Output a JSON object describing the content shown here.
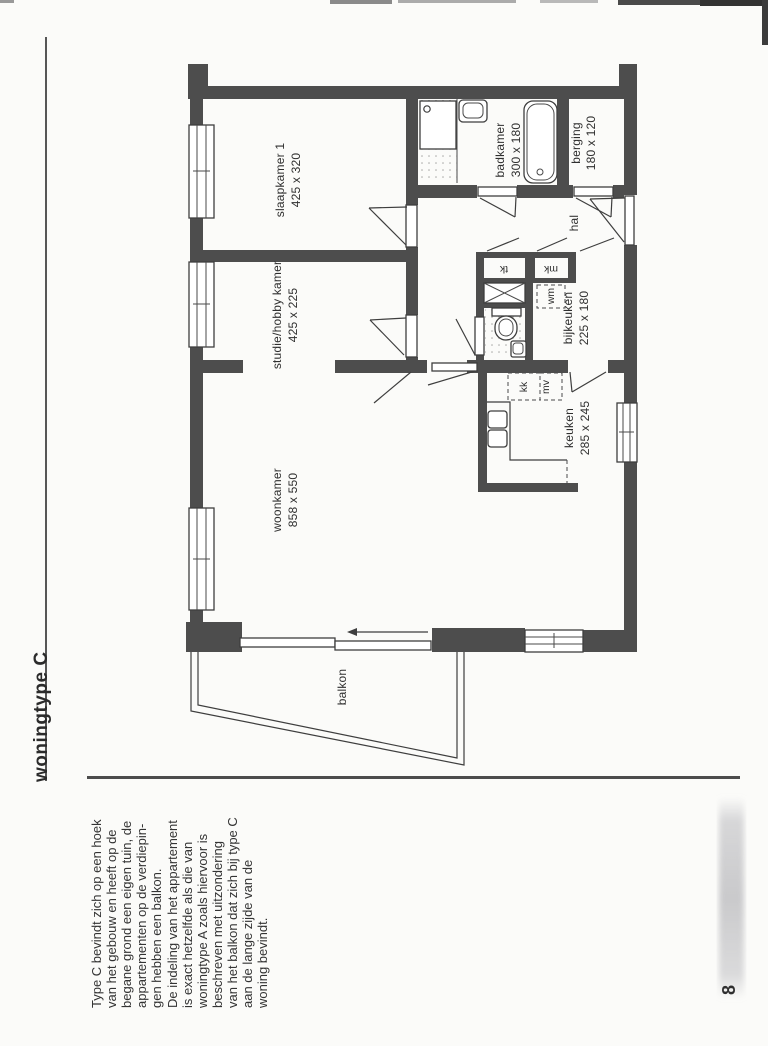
{
  "page": {
    "title": "woningtype C",
    "page_number": "8",
    "paragraph_lines": [
      "Type C bevindt zich op een hoek",
      "van het gebouw en heeft op de",
      "begane grond een eigen tuin, de",
      "appartementen op de verdiepin-",
      "gen hebben een balkon.",
      "De indeling van het appartement",
      "is exact hetzelfde als die van",
      "woningtype A  zoals hiervoor is",
      "beschreven met uitzondering",
      "van het balkon dat zich bij type C",
      "aan de lange zijde van de",
      "woning bevindt."
    ]
  },
  "floorplan": {
    "rooms": {
      "slaapkamer": {
        "name": "slaapkamer 1",
        "size": "425 x 320"
      },
      "studie": {
        "name": "studie/hobby kamer",
        "size": "425 x 225"
      },
      "woonkamer": {
        "name": "woonkamer",
        "size": "858 x 550"
      },
      "badkamer": {
        "name": "badkamer",
        "size": "300 x 180"
      },
      "berging": {
        "name": "berging",
        "size": "180 x 120"
      },
      "bijkeuken": {
        "name": "bijkeuken",
        "size": "225 x 180"
      },
      "keuken": {
        "name": "keuken",
        "size": "285 x 245"
      },
      "hal": {
        "name": "hal"
      },
      "balkon": {
        "name": "balkon"
      }
    },
    "labels": {
      "tk": "tk",
      "mk": "mk",
      "wm": "wm",
      "kk": "kk",
      "mv": "mv"
    }
  },
  "colors": {
    "wall": "#4d4d4d",
    "line": "#3e3e3e",
    "paper": "#fbfbf9",
    "text": "#2f2f2f"
  }
}
